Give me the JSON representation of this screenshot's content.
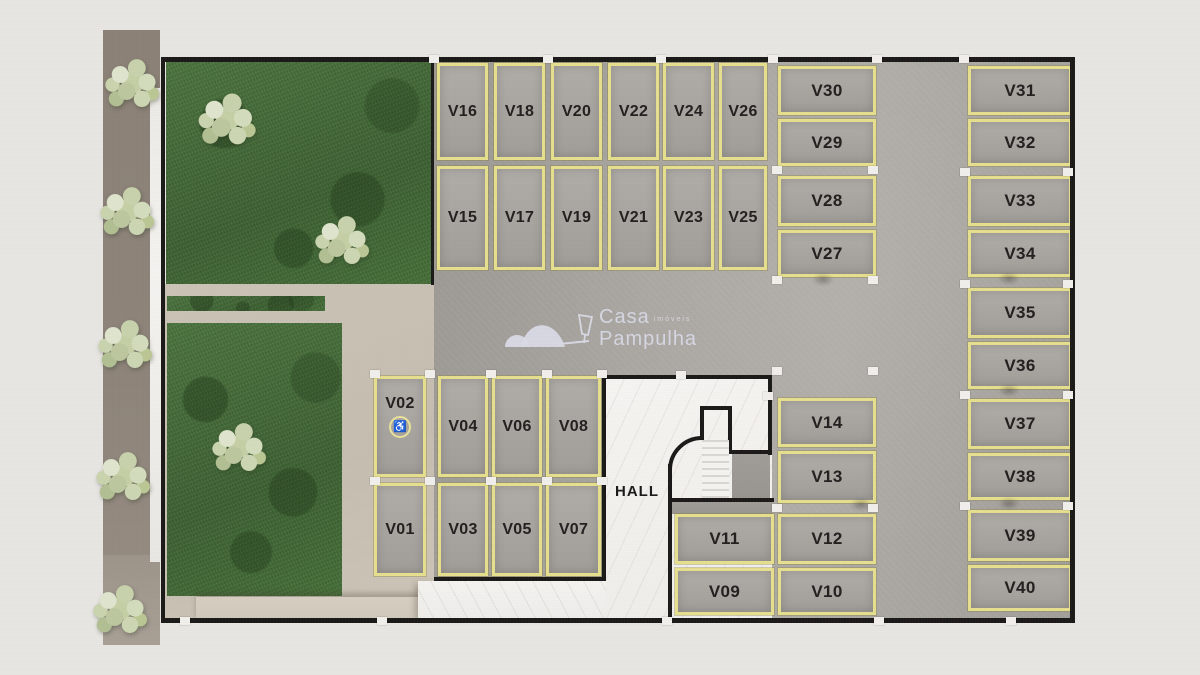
{
  "site": {
    "hall": {
      "label": "HALL"
    },
    "logo": {
      "brand_line1": "Casa",
      "brand_line1_suffix": "imóveis",
      "brand_line2": "Pampulha"
    },
    "icons": {
      "wheelchair": "♿"
    },
    "stalls": {
      "v01": "V01",
      "v02": "V02",
      "v03": "V03",
      "v04": "V04",
      "v05": "V05",
      "v06": "V06",
      "v07": "V07",
      "v08": "V08",
      "v09": "V09",
      "v10": "V10",
      "v11": "V11",
      "v12": "V12",
      "v13": "V13",
      "v14": "V14",
      "v15": "V15",
      "v16": "V16",
      "v17": "V17",
      "v18": "V18",
      "v19": "V19",
      "v20": "V20",
      "v21": "V21",
      "v22": "V22",
      "v23": "V23",
      "v24": "V24",
      "v25": "V25",
      "v26": "V26",
      "v27": "V27",
      "v28": "V28",
      "v29": "V29",
      "v30": "V30",
      "v31": "V31",
      "v32": "V32",
      "v33": "V33",
      "v34": "V34",
      "v35": "V35",
      "v36": "V36",
      "v37": "V37",
      "v38": "V38",
      "v39": "V39",
      "v40": "V40"
    },
    "colors": {
      "stall_outline": "#e6df8e",
      "grass": "#46703b",
      "concrete": "#a8a4a0",
      "path_tan": "#c9c1b3",
      "wall": "#1b1a18",
      "marble": "#f3f1ee",
      "logo_text": "#d5d6e2",
      "background": "#e8e6e3",
      "sidewalk": "#8d8379"
    }
  }
}
